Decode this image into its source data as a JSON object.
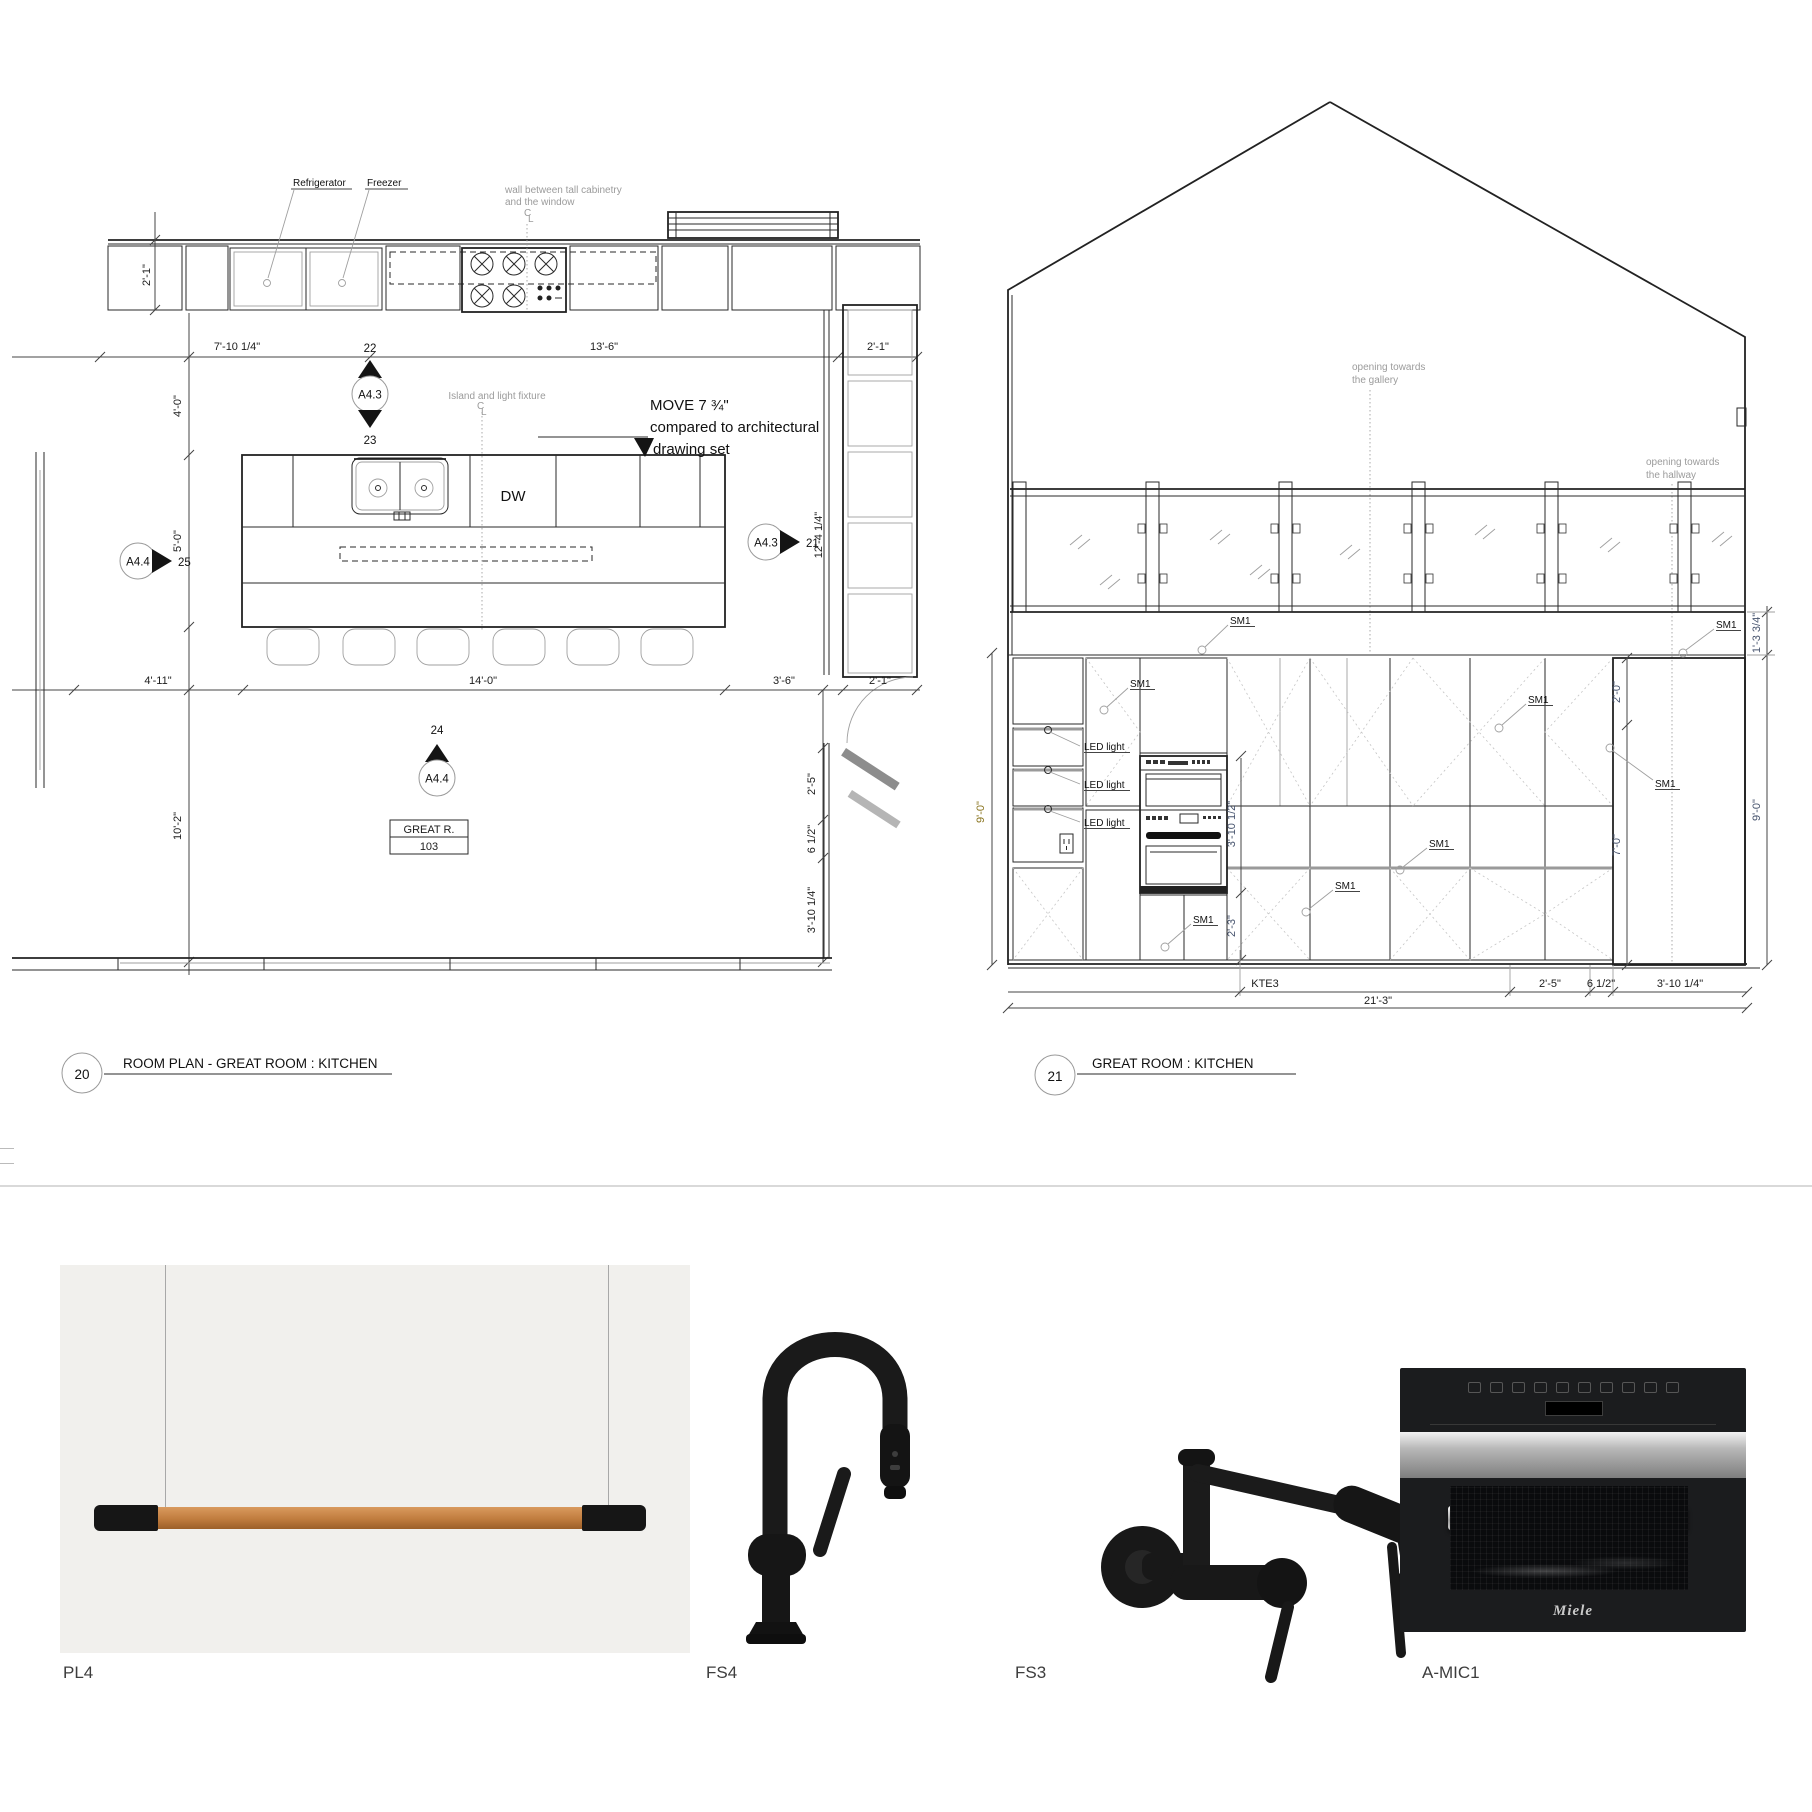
{
  "plan": {
    "number": "20",
    "title": "ROOM PLAN - GREAT ROOM : KITCHEN",
    "notes": {
      "refrigerator": "Refrigerator",
      "freezer": "Freezer",
      "wall_note_line1": "wall between tall cabinetry",
      "wall_note_line2": "and the window",
      "island_note": "Island and light fixture",
      "move_line1": "MOVE 7 ¾\"",
      "move_line2": "compared to architectural",
      "move_line3": "drawing set"
    },
    "labels": {
      "dishwasher": "DW",
      "room_name": "GREAT R.",
      "room_number": "103"
    },
    "markers": {
      "a43": "A4.3",
      "a44": "A4.4",
      "n21": "21",
      "n22": "22",
      "n23": "23",
      "n24": "24",
      "n25": "25"
    },
    "dims": {
      "top_left_height": "2'-1\"",
      "top_span1": "7'-10 1/4\"",
      "top_span2": "13'-6\"",
      "top_right": "2'-1\"",
      "left_upper": "4'-0\"",
      "left_mid": "5'-0\"",
      "left_lower": "10'-2\"",
      "right_depth": "12'-4 1/4\"",
      "bottom_left": "4'-11\"",
      "bottom_island": "14'-0\"",
      "bottom_right": "3'-6\"",
      "bottom_cabinet": "2'-1\"",
      "side_upper": "2'-5\"",
      "side_mid": "6 1/2\"",
      "side_lower": "3'-10 1/4\""
    }
  },
  "elevation": {
    "number": "21",
    "title": "GREAT ROOM : KITCHEN",
    "notes": {
      "gallery_line1": "opening towards",
      "gallery_line2": "the gallery",
      "hallway_line1": "opening towards",
      "hallway_line2": "the hallway"
    },
    "callouts": {
      "sm1": "SM1",
      "led": "LED light",
      "kte3": "KTE3"
    },
    "dims": {
      "left_height": "9'-0\"",
      "right_height": "9'-0\"",
      "right_top": "1'-3 3/4\"",
      "pantry_upper": "2'-0\"",
      "pantry_lower": "7'-0\"",
      "oven_stack": "3'-10 1/2\"",
      "oven_below": "2'-3\"",
      "bottom_total": "21'-3\"",
      "bottom_seg1": "2'-5\"",
      "bottom_seg2": "6 1/2\"",
      "bottom_seg3": "3'-10 1/4\""
    }
  },
  "products": {
    "items": [
      {
        "id": "PL4"
      },
      {
        "id": "FS4"
      },
      {
        "id": "FS3"
      },
      {
        "id": "A-MIC1"
      }
    ],
    "microwave_brand": "Miele"
  }
}
